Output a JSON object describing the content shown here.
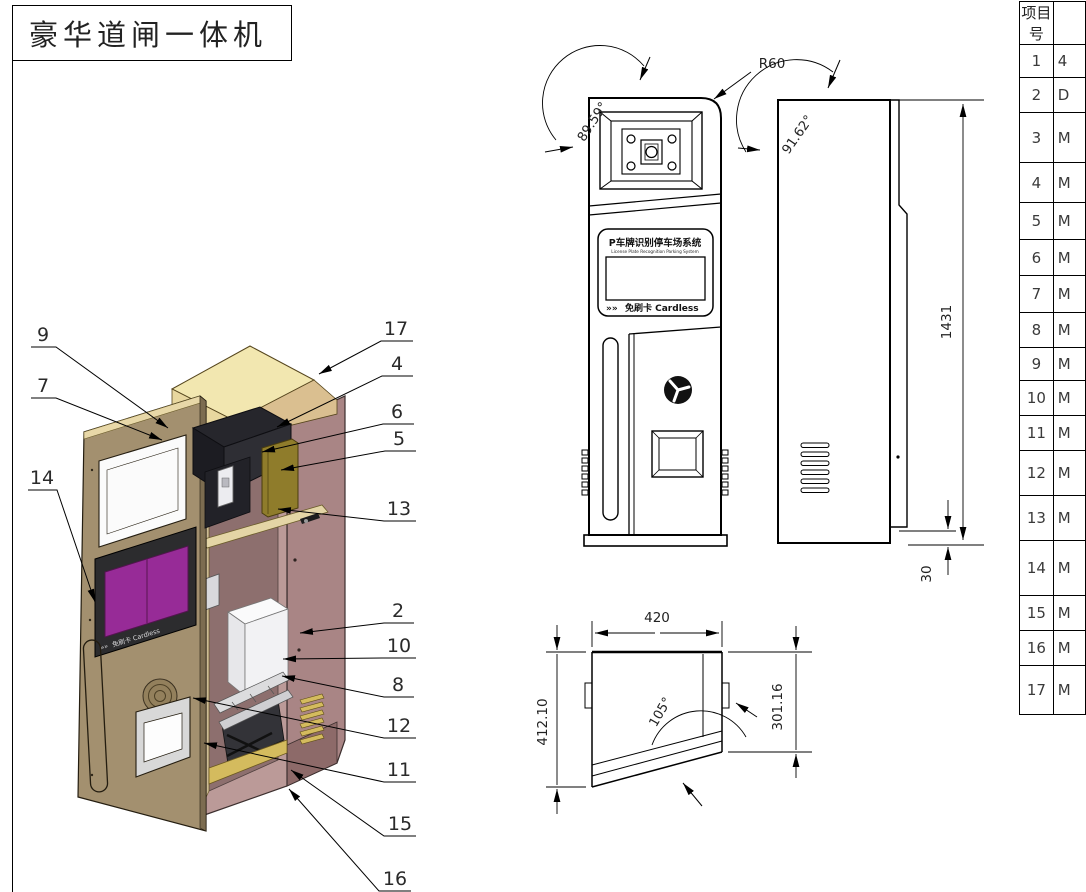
{
  "title_block": {
    "title": "豪华道闸一体机"
  },
  "parts_table": {
    "header": "项目号",
    "rows": [
      {
        "no": "1",
        "part": "4"
      },
      {
        "no": "2",
        "part": "D"
      },
      {
        "no": "3",
        "part": "M"
      },
      {
        "no": "4",
        "part": "M"
      },
      {
        "no": "5",
        "part": "M"
      },
      {
        "no": "6",
        "part": "M"
      },
      {
        "no": "7",
        "part": "M"
      },
      {
        "no": "8",
        "part": "M"
      },
      {
        "no": "9",
        "part": "M"
      },
      {
        "no": "10",
        "part": "M"
      },
      {
        "no": "11",
        "part": "M"
      },
      {
        "no": "12",
        "part": "M"
      },
      {
        "no": "13",
        "part": "M"
      },
      {
        "no": "14",
        "part": "M"
      },
      {
        "no": "15",
        "part": "M"
      },
      {
        "no": "16",
        "part": "M"
      },
      {
        "no": "17",
        "part": "M"
      }
    ]
  },
  "callouts": [
    "9",
    "7",
    "14",
    "17",
    "4",
    "6",
    "5",
    "13",
    "2",
    "10",
    "8",
    "12",
    "11",
    "15",
    "16"
  ],
  "dimensions": {
    "corner_radius": "R60",
    "front_angle": "89.59°",
    "side_angle": "91.62°",
    "height": "1431",
    "base_height": "30",
    "width": "420",
    "depth_left": "412.10",
    "depth_right": "301.16",
    "door_angle": "105°"
  },
  "sign": {
    "title": "P车牌识别停车场系统",
    "subtitle": "License Plate Recognition Parking System",
    "chevrons": "»»",
    "cardless": "免刷卡  Cardless"
  },
  "colors": {
    "top_cover": "#f2e7b0",
    "top_edge": "#dabf90",
    "cabinet_side": "#a98585",
    "cabinet_front": "#bb9a98",
    "cabinet_inner": "#8d6f6e",
    "frame_cream": "#e6d6ac",
    "door_tan": "#a3906f",
    "door_edge": "#7c6c50",
    "screen_purple": "#972b97",
    "hood_dark": "#26262c",
    "brass": "#8f7c2b",
    "gold": "#d4bb5e",
    "white_box": "#f1f1f4"
  }
}
